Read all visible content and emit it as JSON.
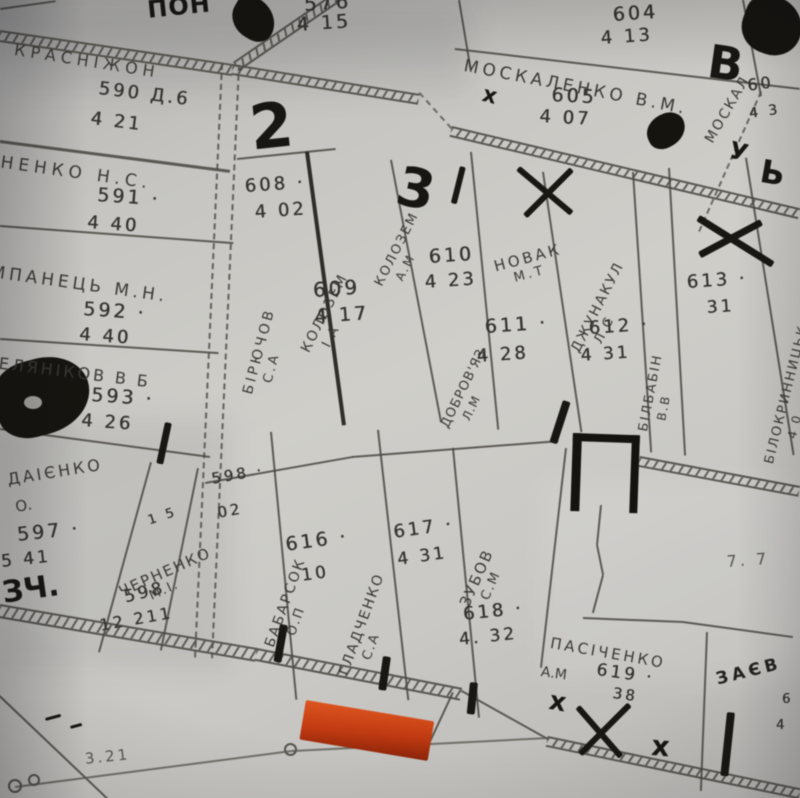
{
  "map": {
    "parcels": {
      "krasnizhon": {
        "name": "КРАСНІЖОН",
        "num": "590 Д.6",
        "area": "4 21"
      },
      "p576": {
        "num": "576",
        "area": "4 15"
      },
      "p604": {
        "num": "604",
        "area": "4 13"
      },
      "moskalenko": {
        "name": "МОСКАЛЕНКО В.М.",
        "num": "605",
        "area": "4 07"
      },
      "moskal2": {
        "name": "МОСКАЛ",
        "num": "60",
        "area": "4 3"
      },
      "dnenko": {
        "name": "ДНЕНКО Н.С.",
        "num": "591 ·",
        "area": "4 40"
      },
      "mpanets": {
        "name": "МПАНЕЦЬ М.Н.",
        "num": "592 ·",
        "area": "4 40"
      },
      "selyanikov": {
        "name": "СЕЛЯНІКОВ В Б",
        "num": "593 ·",
        "area": "4 26"
      },
      "daienko": {
        "name": "ДАІЄНКО",
        "init": "О.",
        "num": "597 ·",
        "area": "5 41"
      },
      "chernenko": {
        "name": "ЧЕРНЕНКО",
        "init": "М.І.",
        "num": "598",
        "area": "12 211",
        "note": "1 5"
      },
      "p598b": {
        "num": "598 ·",
        "area": "02"
      },
      "biryuchov": {
        "name": "БІРЮЧОВ",
        "init": "С.А",
        "num": "608 ·",
        "area": "4 02"
      },
      "kolozem1": {
        "name": "КОЛОЗЕМ",
        "init": "І.А",
        "num": "609",
        "area": "4 17"
      },
      "kolozem2": {
        "name": "КОЛОЗЕМ",
        "init": "А.М"
      },
      "dobrovyaz": {
        "name": "ДОБРОВ'ЯЗ",
        "init": "Л.М",
        "num": "610",
        "area": "4 23"
      },
      "novak": {
        "name": "НОВАК",
        "init": "М.Т",
        "num": "611 ·",
        "area": "4 28"
      },
      "dzhunakul": {
        "name": "ДЖУНАКУЛ",
        "init": "Л.С",
        "num": "612 ·",
        "area": "4 31"
      },
      "bilbabin": {
        "name": "БІЛБАБІН",
        "init": "В.В"
      },
      "p613": {
        "num": "613 ·",
        "area": "31"
      },
      "bilokrynnytsk": {
        "name": "БІЛОКРИННИЦЬК",
        "area": "4 0"
      },
      "babarsok": {
        "name": "БАБАРСОК",
        "init": "О.П",
        "num": "616 ·",
        "area": "10"
      },
      "gladchenko": {
        "name": "ГЛАДЧЕНКО",
        "init": "С.А",
        "num": "617 ·",
        "area": "4 31"
      },
      "zubov": {
        "name": "ЗУБОВ",
        "init": "С.М",
        "num": "618 ·",
        "area": "4. 32"
      },
      "pasichenko": {
        "name": "ПАСІЧЕНКО",
        "init": "А.М",
        "num": "619 ·",
        "area": "38"
      },
      "zaev": {
        "name": "ЗАЄВ",
        "d1": "6",
        "d2": "4"
      }
    },
    "labels": {
      "top_bold": "ПОН",
      "field": "7. 7",
      "distance": "3.21"
    },
    "marks": {
      "two": "2",
      "three": "3",
      "letter_b": "В",
      "letter_u": "У",
      "letter_soft": "Ь",
      "scribble": "ЗЧ.",
      "x": "х"
    },
    "colors": {
      "paper": "#c7c6c2",
      "ink": "#34332f",
      "marker": "#161512",
      "highlight": "#cc4315",
      "highlight_dark": "#8a2409"
    }
  }
}
